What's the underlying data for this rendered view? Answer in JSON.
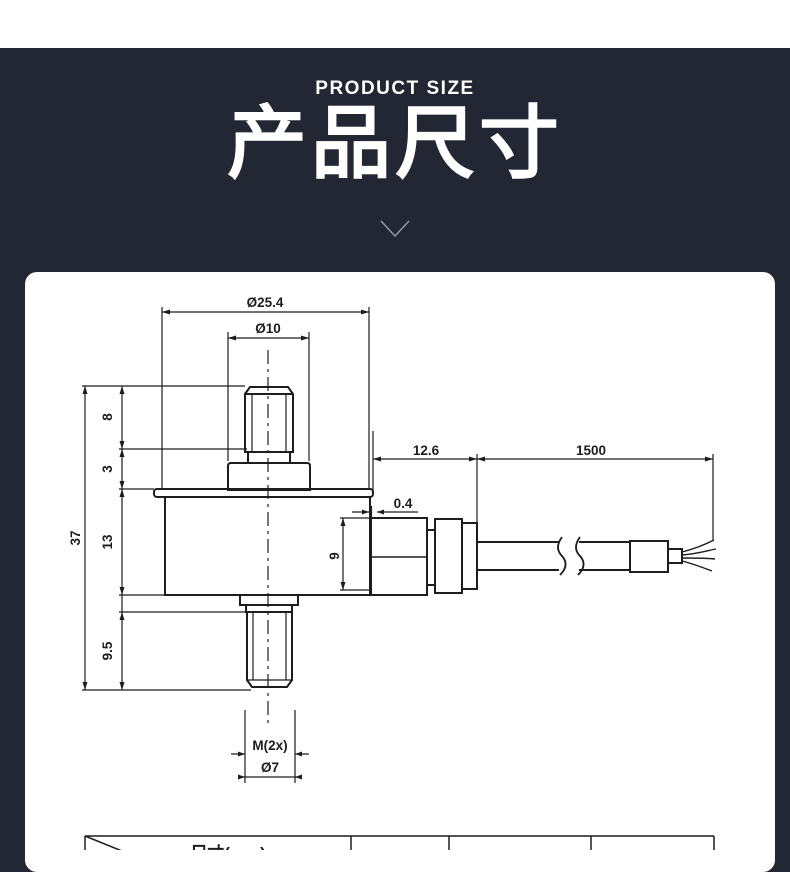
{
  "header": {
    "subtitle_en": "PRODUCT SIZE",
    "title_cn": "产品尺寸"
  },
  "drawing": {
    "dims": {
      "flange_diameter": "Ø25.4",
      "boss_diameter": "Ø10",
      "top_stud_height": "8",
      "boss_height": "3",
      "body_height": "13",
      "total_height": "37",
      "lower_stud_height": "9.5",
      "connector_length": "12.6",
      "cable_length": "1500",
      "lip_overhang": "0.4",
      "connector_height": "9",
      "thread_spec": "M(2x)",
      "lower_stud_diameter": "Ø7"
    }
  },
  "table": {
    "header_label": "尺寸(mm)"
  },
  "colors": {
    "background_dark": "#222733",
    "card_background": "#ffffff",
    "line_color": "#1d1d1f",
    "chevron_color": "#9196a3"
  }
}
